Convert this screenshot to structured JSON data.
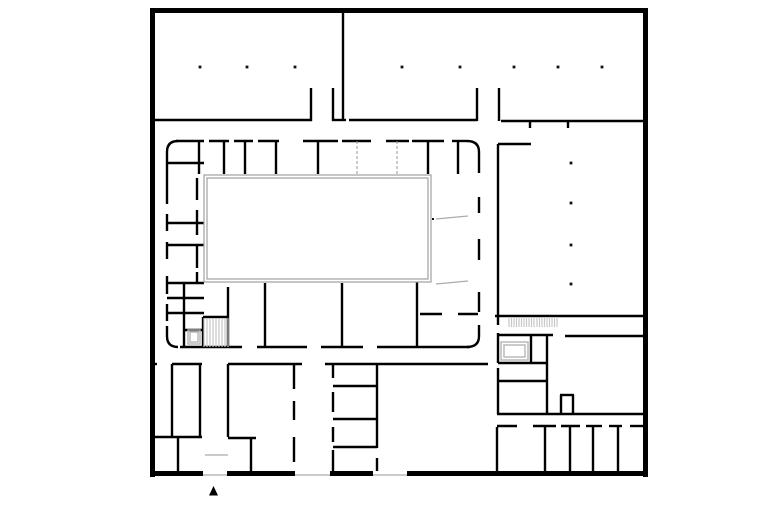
{
  "canvas": {
    "width": 780,
    "height": 520,
    "background": "#ffffff"
  },
  "colors": {
    "wall": "#000000",
    "light_line": "#ababab",
    "gray_partition": "#9a9a9a",
    "courtyard_outline": "#a0a0a0",
    "fixture_outline": "#b5b5b5",
    "stair_hatch": "#c8c8c8",
    "column": "#111111"
  },
  "floor_plan": {
    "layers": [
      {
        "name": "outer-walls",
        "type": "rect",
        "fill": "#000000",
        "items": [
          [
            150,
            8,
            498,
            5
          ],
          [
            150,
            8,
            5,
            469
          ],
          [
            643,
            8,
            5,
            469
          ],
          [
            150,
            471,
            53,
            5
          ],
          [
            227,
            471,
            68,
            5
          ],
          [
            330,
            471,
            43,
            5
          ],
          [
            407,
            471,
            241,
            5
          ]
        ]
      },
      {
        "name": "interior-walls",
        "type": "line",
        "stroke": "#000000",
        "width": 2.4,
        "items": [
          [
            155,
            120,
            312,
            120
          ],
          [
            311,
            88,
            311,
            121
          ],
          [
            333,
            88,
            333,
            121
          ],
          [
            332,
            120,
            346,
            120
          ],
          [
            343,
            12,
            343,
            121
          ],
          [
            349,
            120,
            477,
            120
          ],
          [
            477,
            88,
            477,
            121
          ],
          [
            499,
            88,
            499,
            121
          ],
          [
            501,
            121,
            643,
            121
          ],
          [
            530,
            121,
            530,
            128
          ],
          [
            568,
            121,
            568,
            128
          ],
          [
            498,
            144,
            531,
            144
          ],
          [
            498,
            144,
            498,
            316
          ],
          [
            495,
            316,
            648,
            316
          ],
          [
            565,
            336,
            648,
            336
          ],
          [
            498,
            335,
            553,
            335
          ],
          [
            531,
            335,
            531,
            363
          ],
          [
            547,
            335,
            547,
            414
          ],
          [
            498,
            363,
            548,
            363
          ],
          [
            498,
            381,
            547,
            381
          ],
          [
            498,
            316,
            498,
            325
          ],
          [
            498,
            333,
            498,
            363
          ],
          [
            498,
            368,
            498,
            414
          ],
          [
            560,
            395,
            574,
            395
          ],
          [
            561,
            395,
            561,
            414
          ],
          [
            573,
            395,
            573,
            414
          ],
          [
            497,
            414,
            648,
            414
          ],
          [
            497,
            427,
            497,
            471
          ],
          [
            545,
            427,
            545,
            471
          ],
          [
            570,
            427,
            570,
            471
          ],
          [
            593,
            427,
            593,
            471
          ],
          [
            618,
            427,
            618,
            471
          ],
          [
            497,
            426,
            517,
            426
          ],
          [
            533,
            426,
            556,
            426
          ],
          [
            561,
            426,
            580,
            426
          ],
          [
            586,
            426,
            602,
            426
          ],
          [
            609,
            426,
            622,
            426
          ],
          [
            630,
            426,
            643,
            426
          ],
          [
            176,
            141,
            204,
            141
          ],
          [
            209,
            141,
            229,
            141
          ],
          [
            234,
            141,
            253,
            141
          ],
          [
            258,
            141,
            279,
            141
          ],
          [
            303,
            141,
            338,
            141
          ],
          [
            342,
            141,
            371,
            141
          ],
          [
            386,
            141,
            409,
            141
          ],
          [
            412,
            141,
            444,
            141
          ],
          [
            452,
            141,
            467,
            141
          ],
          [
            167,
            152,
            167,
            204
          ],
          [
            167,
            214,
            167,
            231
          ],
          [
            167,
            242,
            167,
            259
          ],
          [
            167,
            276,
            167,
            294
          ],
          [
            167,
            304,
            167,
            321
          ],
          [
            167,
            326,
            167,
            336
          ],
          [
            180,
            347,
            242,
            347
          ],
          [
            257,
            347,
            307,
            347
          ],
          [
            321,
            347,
            363,
            347
          ],
          [
            377,
            347,
            470,
            347
          ],
          [
            479,
            152,
            479,
            173
          ],
          [
            479,
            197,
            479,
            213
          ],
          [
            479,
            239,
            479,
            260
          ],
          [
            479,
            292,
            479,
            312
          ],
          [
            479,
            325,
            479,
            336
          ],
          [
            199,
            141,
            199,
            174
          ],
          [
            224,
            141,
            224,
            174
          ],
          [
            245,
            141,
            245,
            174
          ],
          [
            276,
            141,
            276,
            174
          ],
          [
            318,
            141,
            318,
            174
          ],
          [
            428,
            141,
            428,
            174
          ],
          [
            458,
            141,
            458,
            174
          ],
          [
            167,
            163,
            204,
            163
          ],
          [
            167,
            223,
            204,
            223
          ],
          [
            167,
            245,
            204,
            245
          ],
          [
            167,
            283,
            204,
            283
          ],
          [
            167,
            298,
            204,
            298
          ],
          [
            167,
            313,
            204,
            313
          ],
          [
            184,
            330,
            204,
            330
          ],
          [
            184,
            283,
            184,
            347
          ],
          [
            228,
            287,
            228,
            347
          ],
          [
            265,
            283,
            265,
            347
          ],
          [
            342,
            283,
            342,
            347
          ],
          [
            417,
            282,
            417,
            347
          ],
          [
            420,
            314,
            442,
            314
          ],
          [
            458,
            314,
            478,
            314
          ],
          [
            197,
            178,
            197,
            200
          ],
          [
            197,
            210,
            197,
            235
          ],
          [
            197,
            245,
            197,
            268
          ],
          [
            197,
            272,
            197,
            283
          ],
          [
            203,
            317,
            203,
            347
          ],
          [
            203,
            317,
            228,
            317
          ],
          [
            150,
            364,
            157,
            364
          ],
          [
            172,
            364,
            202,
            364
          ],
          [
            228,
            364,
            302,
            364
          ],
          [
            325,
            364,
            488,
            364
          ],
          [
            172,
            364,
            172,
            436
          ],
          [
            200,
            364,
            200,
            437
          ],
          [
            228,
            364,
            228,
            437
          ],
          [
            150,
            437,
            202,
            437
          ],
          [
            178,
            437,
            178,
            471
          ],
          [
            228,
            438,
            256,
            438
          ],
          [
            251,
            438,
            251,
            471
          ],
          [
            294,
            364,
            294,
            389
          ],
          [
            294,
            401,
            294,
            420
          ],
          [
            294,
            437,
            294,
            462
          ],
          [
            333,
            364,
            333,
            378
          ],
          [
            333,
            392,
            333,
            412
          ],
          [
            333,
            427,
            333,
            442
          ],
          [
            333,
            450,
            333,
            471
          ],
          [
            377,
            364,
            377,
            448
          ],
          [
            377,
            458,
            377,
            471
          ],
          [
            333,
            386,
            377,
            386
          ],
          [
            333,
            419,
            377,
            419
          ],
          [
            333,
            447,
            377,
            447
          ]
        ]
      },
      {
        "name": "ring-corner-arcs",
        "type": "path",
        "stroke": "#000000",
        "width": 2.4,
        "items": [
          "M167,152 Q167,141 178,141",
          "M467,141 Q479,141 479,152",
          "M167,336 Q167,347 178,347",
          "M467,347 Q479,347 479,336"
        ]
      },
      {
        "name": "window-and-door-light-lines",
        "type": "line",
        "stroke": "#ababab",
        "width": 1.2,
        "items": [
          [
            203,
            475,
            227,
            475
          ],
          [
            295,
            475,
            330,
            475
          ],
          [
            373,
            475,
            407,
            475
          ],
          [
            205,
            455,
            228,
            455
          ],
          [
            436,
            219,
            468,
            216
          ],
          [
            436,
            284,
            468,
            281
          ]
        ]
      },
      {
        "name": "gray-dashed-partitions",
        "type": "line",
        "stroke": "#9a9a9a",
        "width": 1,
        "dash": "3,2",
        "items": [
          [
            357,
            141,
            357,
            174
          ],
          [
            397,
            141,
            397,
            174
          ]
        ]
      },
      {
        "name": "courtyard-outline",
        "type": "rect-outline",
        "stroke": "#a0a0a0",
        "width": 1.2,
        "items": [
          [
            204,
            175,
            227,
            107
          ],
          [
            207,
            178,
            221,
            101
          ]
        ]
      },
      {
        "name": "fixture-outlines",
        "type": "rect-outline",
        "stroke": "#b5b5b5",
        "width": 1.4,
        "items": [
          [
            188,
            330,
            12,
            14
          ],
          [
            190,
            332,
            8,
            10
          ],
          [
            501,
            342,
            27,
            18
          ],
          [
            504,
            345,
            21,
            12
          ]
        ]
      },
      {
        "name": "stair-hatches",
        "type": "hatch",
        "stroke": "#c8c8c8",
        "width": 1.2,
        "items": [
          [
            204,
            318,
            24,
            29,
            3
          ],
          [
            509,
            317,
            25,
            10,
            2.5
          ],
          [
            537,
            317,
            22,
            10,
            2.5
          ]
        ]
      },
      {
        "name": "structural-columns",
        "type": "square",
        "fill": "#111111",
        "size": 2.8,
        "items": [
          [
            200,
            67
          ],
          [
            247,
            67
          ],
          [
            295,
            67
          ],
          [
            402,
            67
          ],
          [
            460,
            67
          ],
          [
            514,
            67
          ],
          [
            558,
            67
          ],
          [
            602,
            67
          ],
          [
            571,
            163
          ],
          [
            571,
            203
          ],
          [
            571,
            245
          ],
          [
            571,
            284
          ]
        ]
      },
      {
        "name": "door-pivot-dot",
        "type": "square",
        "fill": "#111111",
        "size": 2,
        "items": [
          [
            433,
            219
          ]
        ]
      },
      {
        "name": "north-entrance-marker",
        "type": "polygon",
        "fill": "#000000",
        "items": [
          "213.5,486 209,495.5 218,495.5"
        ]
      }
    ]
  }
}
